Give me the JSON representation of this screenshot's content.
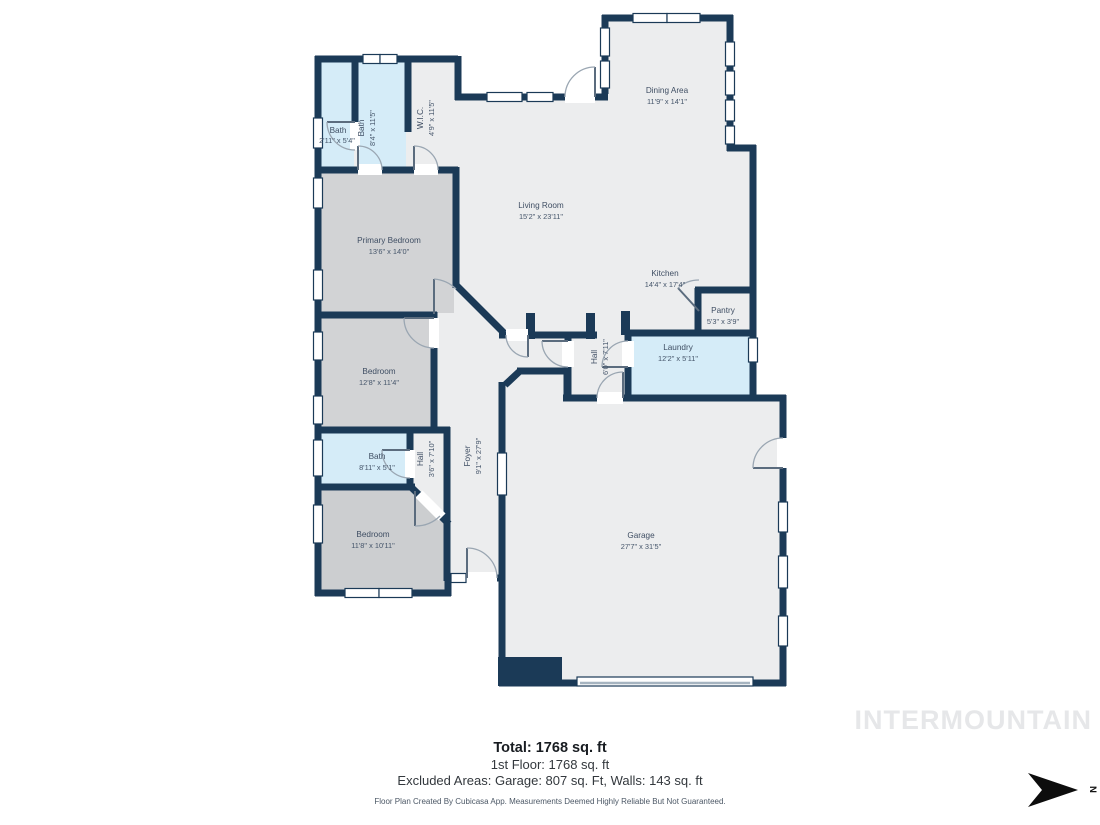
{
  "palette": {
    "wall": "#1b3a57",
    "floor_light": "#ecedee",
    "bedroom_gray": "#d2d3d5",
    "bedroom_dark_gray": "#ccced0",
    "wet_room_blue": "#d5ecf8",
    "label_text": "#3f4e63",
    "watermark_gray": "#e6e7e9"
  },
  "rooms": [
    {
      "id": "bath-small",
      "name": "Bath",
      "dims": "2'11\" x 5'4\""
    },
    {
      "id": "bath-main",
      "name": "Bath",
      "dims": "8'4\" x 11'5\""
    },
    {
      "id": "wic",
      "name": "W.I.C.",
      "dims": "4'9\" x 11'5\""
    },
    {
      "id": "primary-bedroom",
      "name": "Primary Bedroom",
      "dims": "13'6\" x 14'0\""
    },
    {
      "id": "bedroom-middle",
      "name": "Bedroom",
      "dims": "12'8\" x 11'4\""
    },
    {
      "id": "bath-lower",
      "name": "Bath",
      "dims": "8'11\" x 5'1\""
    },
    {
      "id": "hall-lower",
      "name": "Hall",
      "dims": "3'6\" x 7'10\""
    },
    {
      "id": "bedroom-bottom",
      "name": "Bedroom",
      "dims": "11'8\" x 10'11\""
    },
    {
      "id": "foyer",
      "name": "Foyer",
      "dims": "9'1\" x 27'9\""
    },
    {
      "id": "living-room",
      "name": "Living Room",
      "dims": "15'2\" x 23'11\""
    },
    {
      "id": "dining-area",
      "name": "Dining Area",
      "dims": "11'9\" x 14'1\""
    },
    {
      "id": "kitchen",
      "name": "Kitchen",
      "dims": "14'4\" x 17'4\""
    },
    {
      "id": "pantry",
      "name": "Pantry",
      "dims": "5'3\" x 3'9\""
    },
    {
      "id": "hall-upper",
      "name": "Hall",
      "dims": "6'0\" x 7'11\""
    },
    {
      "id": "laundry",
      "name": "Laundry",
      "dims": "12'2\" x 5'11\""
    },
    {
      "id": "garage",
      "name": "Garage",
      "dims": "27'7\" x 31'5\""
    }
  ],
  "summary": {
    "total": "Total: 1768 sq. ft",
    "first_floor": "1st Floor: 1768 sq. ft",
    "excluded": "Excluded Areas: Garage: 807 sq. Ft, Walls: 143 sq. ft"
  },
  "disclaimer": "Floor Plan Created By Cubicasa App. Measurements Deemed Highly Reliable But Not Guaranteed.",
  "watermark": "INTERMOUNTAIN",
  "compass": {
    "label": "N"
  }
}
